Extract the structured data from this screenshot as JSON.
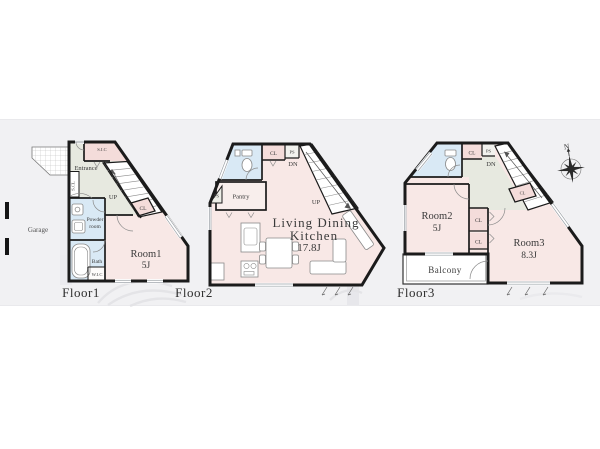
{
  "colors": {
    "wall": "#1b1b1b",
    "room_pink": "#f8e8e6",
    "closet_pink": "#f4dcda",
    "water_blue": "#d9e9f5",
    "hall_green": "#e7e9e0",
    "pantry_pink": "#f8eeec",
    "band": "#f1f1f3",
    "white": "#ffffff"
  },
  "floor1": {
    "label": "Floor1",
    "garage": "Garage",
    "sic": "S.I.C",
    "entrance": "Entrance",
    "scl": "S.CL",
    "up": "UP",
    "cl": "CL",
    "powder_line1": "Powder",
    "powder_line2": "room",
    "bath": "Bath",
    "wic": "W.I.C",
    "room_name": "Room1",
    "room_size": "5J"
  },
  "floor2": {
    "label": "Floor2",
    "cl": "CL",
    "ps_top": "PS",
    "dn": "DN",
    "up": "UP",
    "ps_side": "PS",
    "pantry": "Pantry",
    "ldk_line1": "Living Dining",
    "ldk_line2": "Kitchen",
    "ldk_size": "17.8J"
  },
  "floor3": {
    "label": "Floor3",
    "cl_top": "CL",
    "ps_top": "PS",
    "dn": "DN",
    "cl_stair": "CL",
    "cl_upper": "CL",
    "cl_lower": "CL",
    "room2_name": "Room2",
    "room2_size": "5J",
    "room3_name": "Room3",
    "room3_size": "8.3J",
    "balcony": "Balcony",
    "compass_n": "N"
  }
}
